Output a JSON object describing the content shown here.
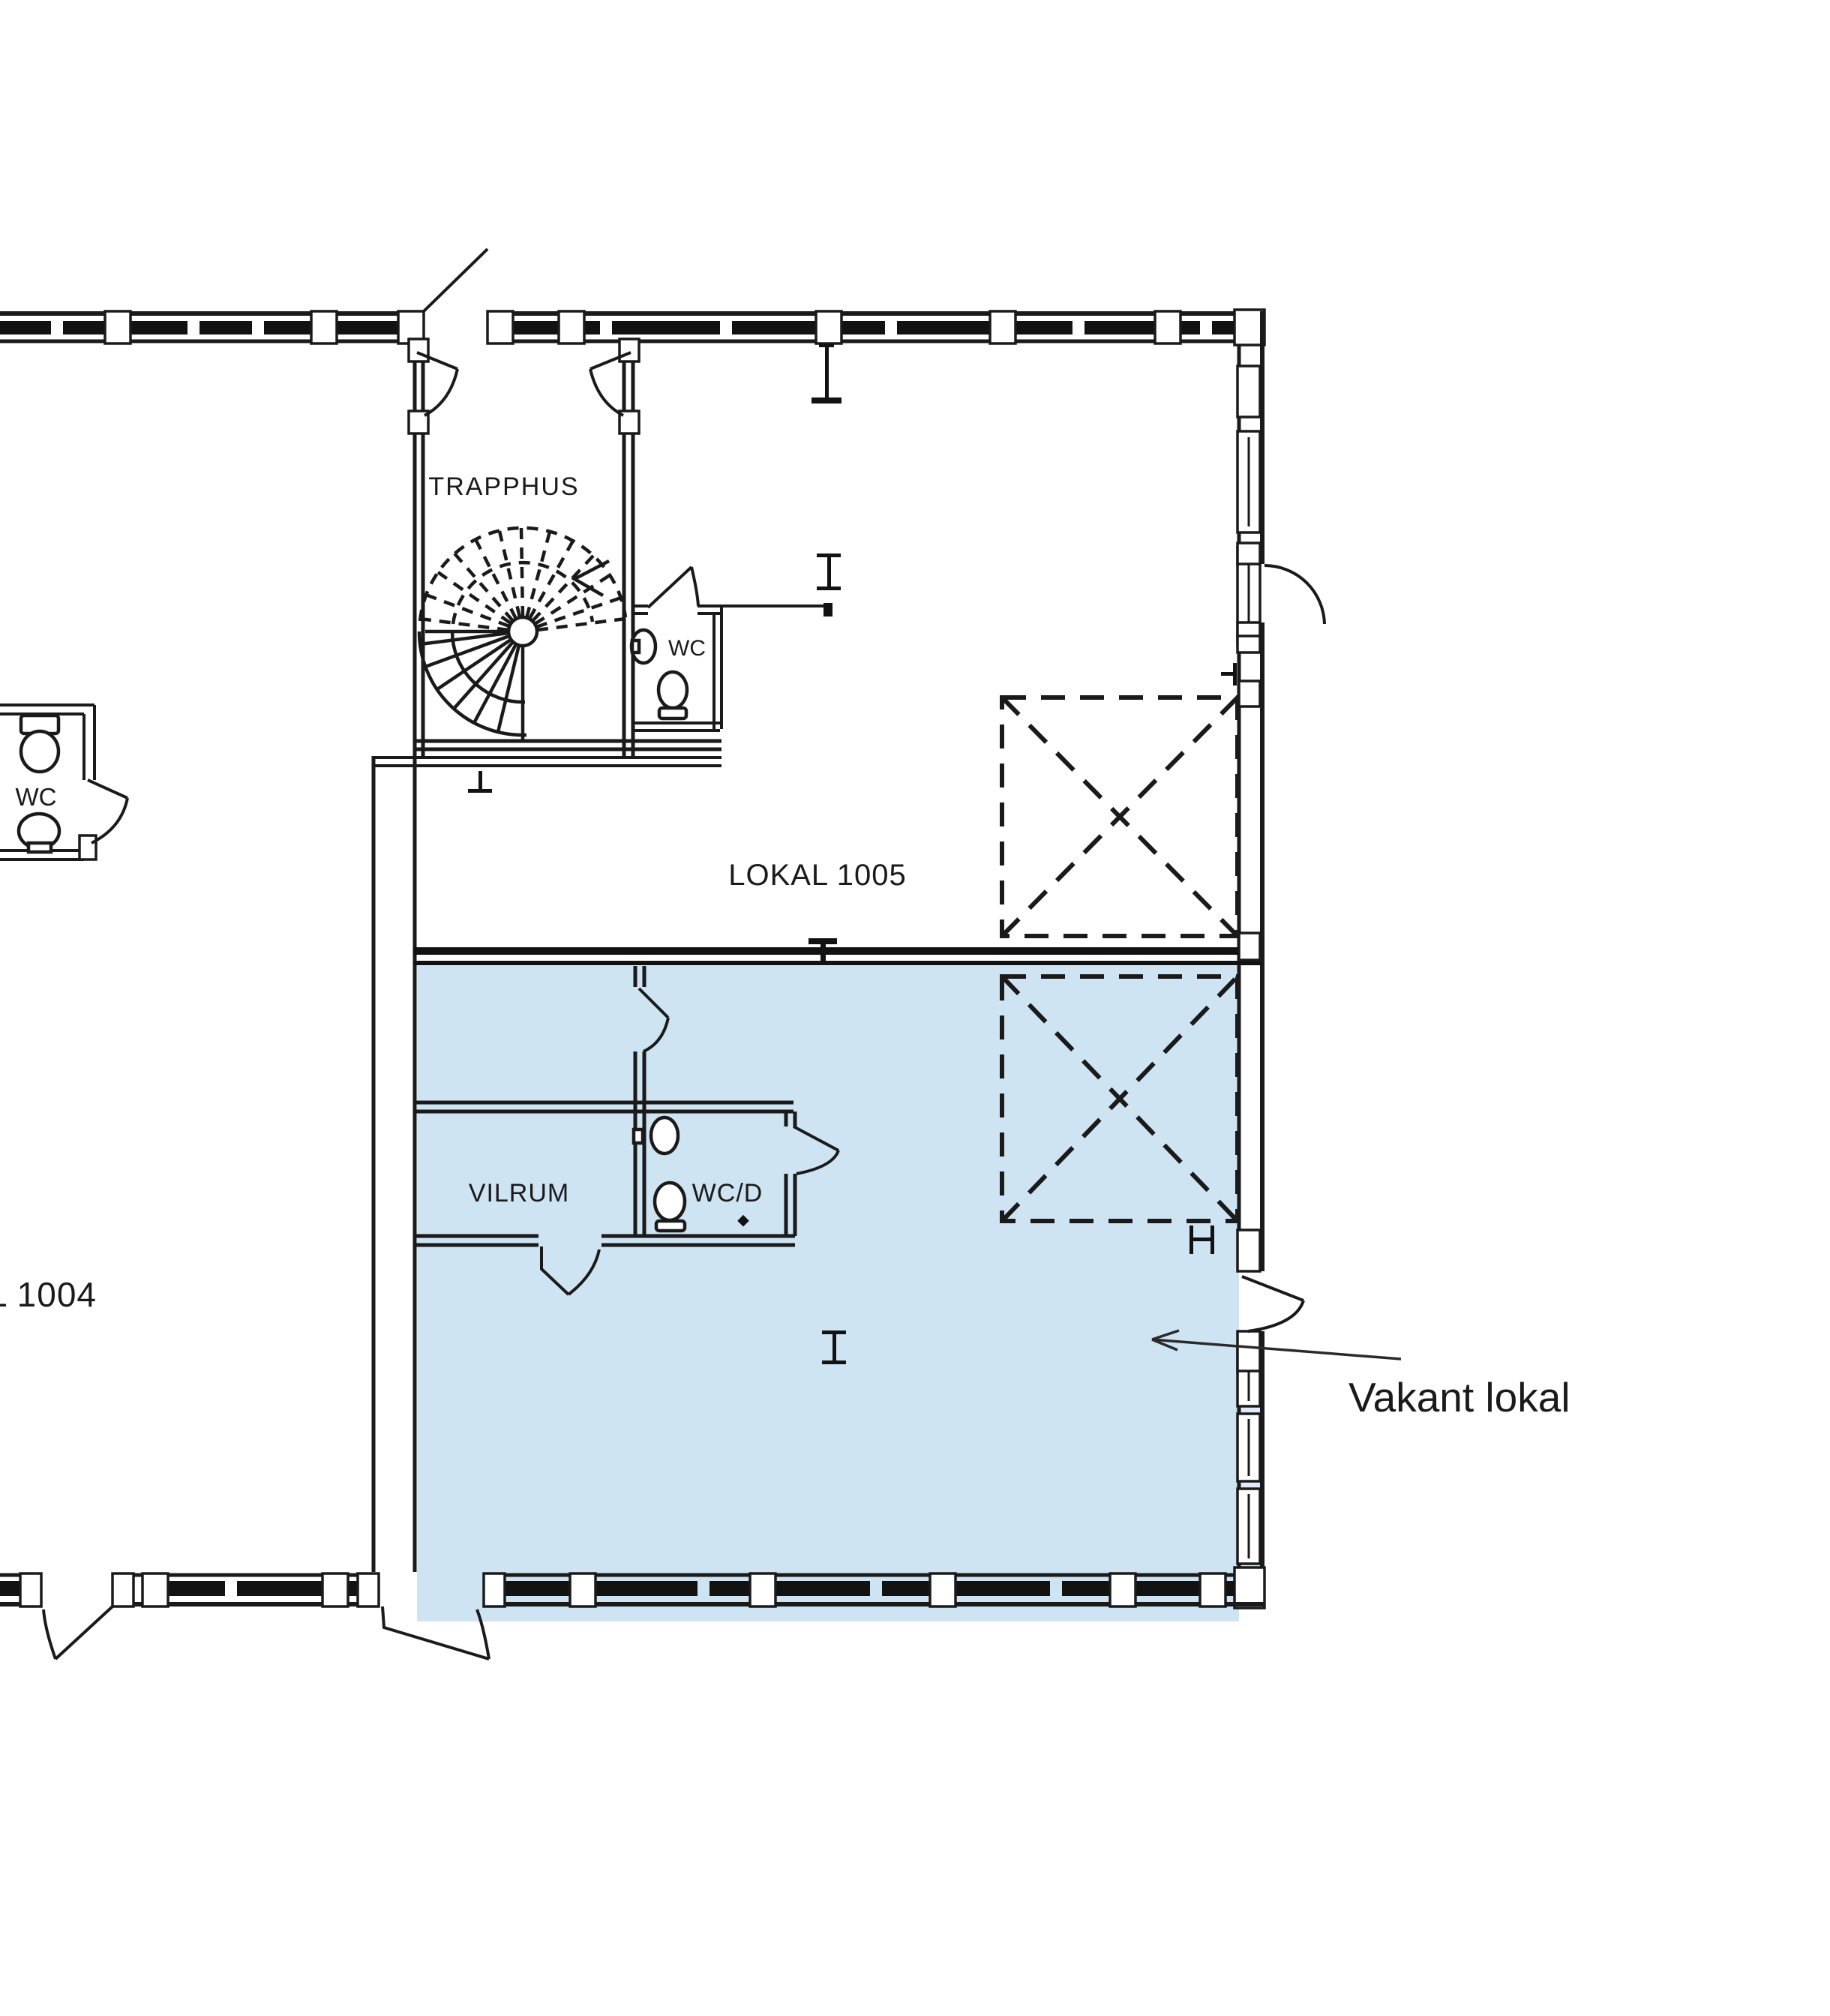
{
  "drawing": {
    "title": "Floor plan with vacant premises",
    "labels": {
      "stairwell": "TRAPPHUS",
      "wc_stair": "WC",
      "lokal_1005": "LOKAL 1005",
      "wc_left": "WC",
      "vilrum": "VILRUM",
      "wcd": "WC/D",
      "lokal_1004": "L 1004",
      "vacant_annotation": "Vakant lokal"
    },
    "colors": {
      "background": "#ffffff",
      "line": "#1a1a1a",
      "vacant_fill": "#cfe4f2",
      "vacant_fill_light": "#ddecf8",
      "text": "#1a1a1a"
    }
  }
}
